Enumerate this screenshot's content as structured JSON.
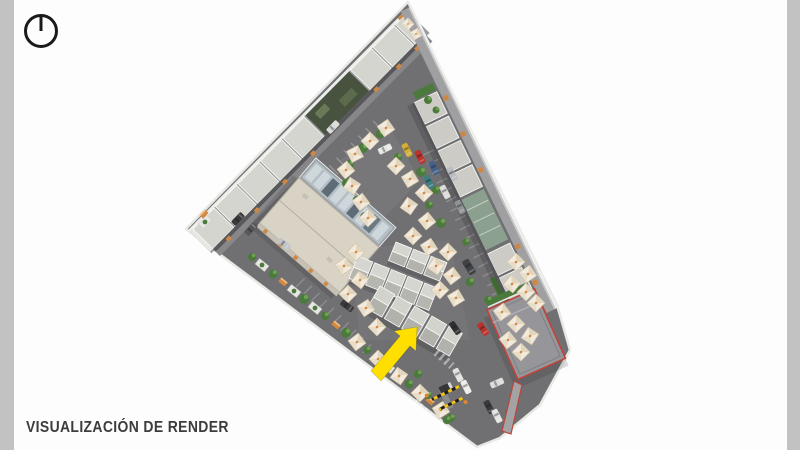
{
  "slide": {
    "title": "VISUALIZACIÓN DE RENDER"
  },
  "compass": {
    "icon": "north-indicator"
  },
  "render": {
    "type": "aerial-site-plan-render",
    "subject": "triangular market site: perimeter building along northwest edge, stall row along northeast edge, central market hall with skylight, three stall rows, food-court umbrellas, parking with cars, planter chain along southwest edge, corner building outlined in red, entrance barrier at south tip",
    "annotation": "yellow-highlight-arrow pointing at lower stall row",
    "colors": {
      "page_bg": "#fdfdfd",
      "margin_strip": "#c2c2c2",
      "asphalt": "#707073",
      "roof_light": "#d5d5d0",
      "roof_cream": "#d9d3c5",
      "skylight_frame": "#99a0a6",
      "skylight_glass": "#cdd7dc",
      "umbrella": "#f2ebdd",
      "umbrella_accent": "#d8883c",
      "greenery": "#4c7a3d",
      "highlight_arrow": "#ffdf00",
      "red_outline": "#bf4339",
      "title_text": "#3c3c3e",
      "compass_stroke": "#1a1a1c"
    }
  }
}
